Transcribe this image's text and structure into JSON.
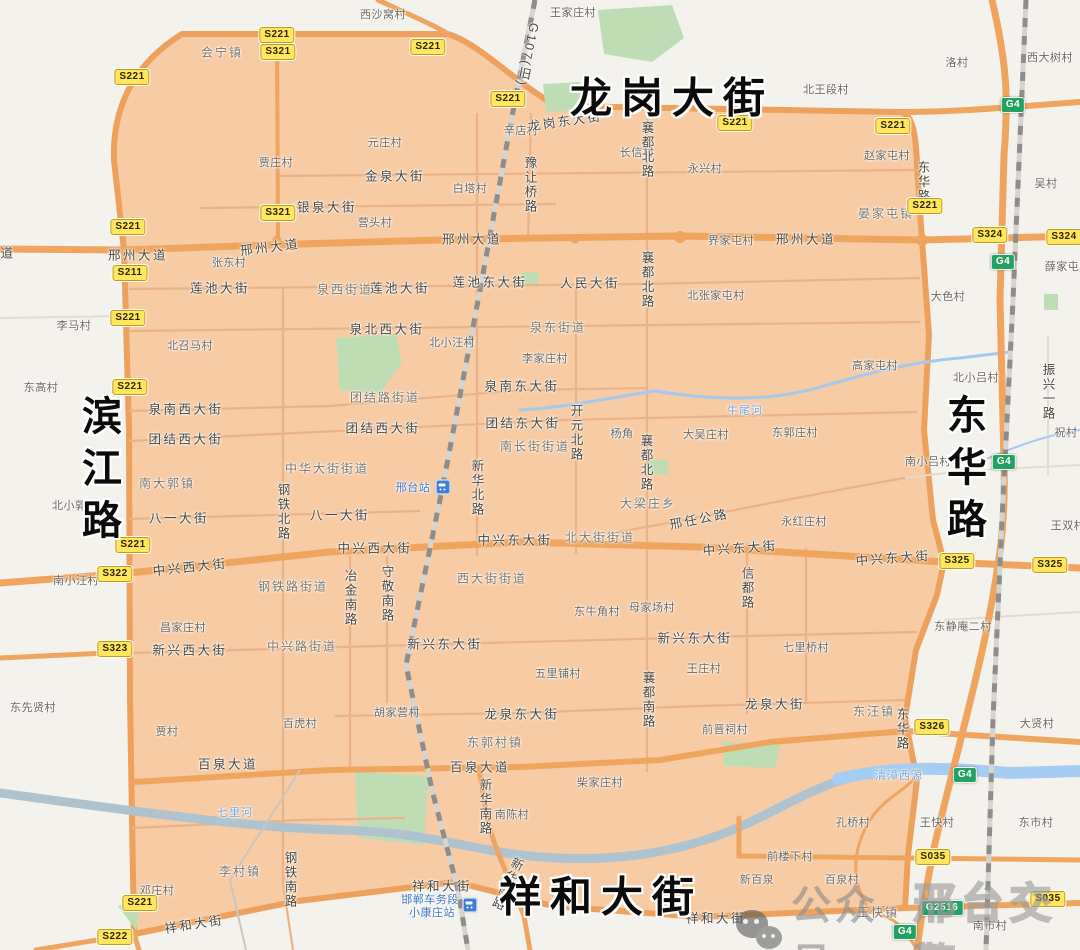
{
  "colors": {
    "zone_fill": "#f7cba4",
    "zone_road": "#eda15c",
    "road_orange": "#efa55e",
    "minor_road": "#eab286",
    "river": "#afc3cf",
    "river_blue": "#a5cdf2",
    "park": "#bfddb4",
    "railway": "#8f8d89",
    "shield_provincial_bg": "#ffe65e",
    "shield_national_bg": "#23a162",
    "big_label": "#0b0b0b"
  },
  "watermark": {
    "icon": "wechat-icon",
    "prefix": "公众号",
    "account": "邢台交警"
  },
  "map": {
    "big_labels_note": "boundary streets of the restricted zone",
    "labels": [
      {
        "t": "龙岗大街",
        "x": 672,
        "y": 95,
        "k": "big"
      },
      {
        "t": "滨江路",
        "x": 98,
        "y": 473,
        "k": "big-v"
      },
      {
        "t": "东华路",
        "x": 963,
        "y": 472,
        "k": "big-v"
      },
      {
        "t": "祥和大街",
        "x": 601,
        "y": 894,
        "k": "big"
      },
      {
        "t": "西沙窝村",
        "x": 383,
        "y": 14,
        "k": "village"
      },
      {
        "t": "王家庄村",
        "x": 573,
        "y": 12,
        "k": "village"
      },
      {
        "t": "元庄村",
        "x": 385,
        "y": 142,
        "k": "village"
      },
      {
        "t": "贾庄村",
        "x": 276,
        "y": 162,
        "k": "village"
      },
      {
        "t": "白塔村",
        "x": 470,
        "y": 188,
        "k": "village"
      },
      {
        "t": "辛店村",
        "x": 521,
        "y": 130,
        "k": "village"
      },
      {
        "t": "长信村",
        "x": 637,
        "y": 152,
        "k": "village"
      },
      {
        "t": "永兴村",
        "x": 705,
        "y": 168,
        "k": "village"
      },
      {
        "t": "北王段村",
        "x": 826,
        "y": 89,
        "k": "village"
      },
      {
        "t": "洛村",
        "x": 957,
        "y": 62,
        "k": "village"
      },
      {
        "t": "西大树村",
        "x": 1050,
        "y": 57,
        "k": "village"
      },
      {
        "t": "赵家屯村",
        "x": 887,
        "y": 155,
        "k": "village"
      },
      {
        "t": "吴村",
        "x": 1046,
        "y": 183,
        "k": "village"
      },
      {
        "t": "张东村",
        "x": 229,
        "y": 262,
        "k": "village"
      },
      {
        "t": "界家屯村",
        "x": 731,
        "y": 240,
        "k": "village"
      },
      {
        "t": "北张家屯村",
        "x": 716,
        "y": 295,
        "k": "village"
      },
      {
        "t": "大色村",
        "x": 948,
        "y": 296,
        "k": "village"
      },
      {
        "t": "薛家屯",
        "x": 1062,
        "y": 266,
        "k": "village"
      },
      {
        "t": "李马村",
        "x": 74,
        "y": 325,
        "k": "village"
      },
      {
        "t": "东高村",
        "x": 41,
        "y": 387,
        "k": "village"
      },
      {
        "t": "北召马村",
        "x": 190,
        "y": 345,
        "k": "village"
      },
      {
        "t": "北小汪村",
        "x": 452,
        "y": 342,
        "k": "village"
      },
      {
        "t": "李家庄村",
        "x": 545,
        "y": 358,
        "k": "village"
      },
      {
        "t": "营头村",
        "x": 375,
        "y": 222,
        "k": "village"
      },
      {
        "t": "高家屯村",
        "x": 875,
        "y": 365,
        "k": "village"
      },
      {
        "t": "北小吕村",
        "x": 976,
        "y": 377,
        "k": "village"
      },
      {
        "t": "大吴庄村",
        "x": 706,
        "y": 434,
        "k": "village"
      },
      {
        "t": "东郭庄村",
        "x": 795,
        "y": 432,
        "k": "village"
      },
      {
        "t": "杨角",
        "x": 622,
        "y": 433,
        "k": "village"
      },
      {
        "t": "祝村",
        "x": 1066,
        "y": 432,
        "k": "village"
      },
      {
        "t": "北小郭村",
        "x": 75,
        "y": 505,
        "k": "village"
      },
      {
        "t": "南小吕村",
        "x": 928,
        "y": 461,
        "k": "village"
      },
      {
        "t": "永红庄村",
        "x": 804,
        "y": 521,
        "k": "village"
      },
      {
        "t": "王双村",
        "x": 1068,
        "y": 525,
        "k": "village"
      },
      {
        "t": "南小汪村",
        "x": 76,
        "y": 580,
        "k": "village"
      },
      {
        "t": "东牛角村",
        "x": 597,
        "y": 611,
        "k": "village"
      },
      {
        "t": "母家场村",
        "x": 652,
        "y": 607,
        "k": "village"
      },
      {
        "t": "东静庵二村",
        "x": 963,
        "y": 626,
        "k": "village"
      },
      {
        "t": "七里桥村",
        "x": 806,
        "y": 647,
        "k": "village"
      },
      {
        "t": "王庄村",
        "x": 704,
        "y": 668,
        "k": "village"
      },
      {
        "t": "五里铺村",
        "x": 558,
        "y": 673,
        "k": "village"
      },
      {
        "t": "昌家庄村",
        "x": 183,
        "y": 627,
        "k": "village"
      },
      {
        "t": "百虎村",
        "x": 300,
        "y": 723,
        "k": "village"
      },
      {
        "t": "贾村",
        "x": 167,
        "y": 731,
        "k": "village"
      },
      {
        "t": "东先贤村",
        "x": 33,
        "y": 707,
        "k": "village"
      },
      {
        "t": "胡家营村",
        "x": 397,
        "y": 712,
        "k": "village"
      },
      {
        "t": "柴家庄村",
        "x": 600,
        "y": 782,
        "k": "village"
      },
      {
        "t": "南陈村",
        "x": 512,
        "y": 814,
        "k": "village"
      },
      {
        "t": "前晋祠村",
        "x": 725,
        "y": 729,
        "k": "village"
      },
      {
        "t": "大贤村",
        "x": 1037,
        "y": 723,
        "k": "village"
      },
      {
        "t": "孔桥村",
        "x": 853,
        "y": 822,
        "k": "village"
      },
      {
        "t": "王快村",
        "x": 937,
        "y": 822,
        "k": "village"
      },
      {
        "t": "东市村",
        "x": 1036,
        "y": 822,
        "k": "village"
      },
      {
        "t": "前楼下村",
        "x": 790,
        "y": 856,
        "k": "village"
      },
      {
        "t": "邓庄村",
        "x": 157,
        "y": 890,
        "k": "village"
      },
      {
        "t": "南市村",
        "x": 990,
        "y": 925,
        "k": "village"
      },
      {
        "t": "新百泉",
        "x": 757,
        "y": 879,
        "k": "village"
      },
      {
        "t": "百泉村",
        "x": 842,
        "y": 879,
        "k": "village"
      },
      {
        "t": "会宁镇",
        "x": 222,
        "y": 52,
        "k": "town"
      },
      {
        "t": "晏家屯镇",
        "x": 886,
        "y": 213,
        "k": "town"
      },
      {
        "t": "泉西街道",
        "x": 345,
        "y": 289,
        "k": "town"
      },
      {
        "t": "泉东街道",
        "x": 558,
        "y": 327,
        "k": "town"
      },
      {
        "t": "团结路街道",
        "x": 385,
        "y": 397,
        "k": "town"
      },
      {
        "t": "南长街街道",
        "x": 535,
        "y": 446,
        "k": "town"
      },
      {
        "t": "中华大街街道",
        "x": 327,
        "y": 468,
        "k": "town"
      },
      {
        "t": "南大郭镇",
        "x": 167,
        "y": 483,
        "k": "town"
      },
      {
        "t": "大梁庄乡",
        "x": 648,
        "y": 503,
        "k": "town"
      },
      {
        "t": "北大街街道",
        "x": 600,
        "y": 537,
        "k": "town"
      },
      {
        "t": "西大街街道",
        "x": 492,
        "y": 578,
        "k": "town"
      },
      {
        "t": "钢铁路街道",
        "x": 293,
        "y": 586,
        "k": "town"
      },
      {
        "t": "中兴路街道",
        "x": 302,
        "y": 646,
        "k": "town"
      },
      {
        "t": "东郭村镇",
        "x": 495,
        "y": 742,
        "k": "town"
      },
      {
        "t": "东汪镇",
        "x": 874,
        "y": 711,
        "k": "town"
      },
      {
        "t": "李村镇",
        "x": 240,
        "y": 871,
        "k": "town"
      },
      {
        "t": "王快镇",
        "x": 878,
        "y": 912,
        "k": "town"
      },
      {
        "t": "龙岗东大街",
        "x": 565,
        "y": 120,
        "k": "road",
        "r": -8
      },
      {
        "t": "道",
        "x": 8,
        "y": 252,
        "k": "road"
      },
      {
        "t": "邢州大道",
        "x": 138,
        "y": 254,
        "k": "road"
      },
      {
        "t": "邢州大道",
        "x": 270,
        "y": 246,
        "k": "road",
        "r": -7
      },
      {
        "t": "邢州大道",
        "x": 472,
        "y": 238,
        "k": "road"
      },
      {
        "t": "邢州大道",
        "x": 806,
        "y": 238,
        "k": "road"
      },
      {
        "t": "金泉大街",
        "x": 395,
        "y": 175,
        "k": "road"
      },
      {
        "t": "银泉大街",
        "x": 327,
        "y": 206,
        "k": "road"
      },
      {
        "t": "莲池大街",
        "x": 220,
        "y": 287,
        "k": "road"
      },
      {
        "t": "莲池大街",
        "x": 400,
        "y": 287,
        "k": "road"
      },
      {
        "t": "莲池东大街",
        "x": 490,
        "y": 281,
        "k": "road"
      },
      {
        "t": "人民大街",
        "x": 590,
        "y": 282,
        "k": "road"
      },
      {
        "t": "泉北西大街",
        "x": 387,
        "y": 328,
        "k": "road"
      },
      {
        "t": "泉南西大街",
        "x": 186,
        "y": 408,
        "k": "road"
      },
      {
        "t": "泉南东大街",
        "x": 522,
        "y": 385,
        "k": "road"
      },
      {
        "t": "团结西大街",
        "x": 186,
        "y": 438,
        "k": "road"
      },
      {
        "t": "团结西大街",
        "x": 383,
        "y": 427,
        "k": "road"
      },
      {
        "t": "团结东大街",
        "x": 523,
        "y": 422,
        "k": "road"
      },
      {
        "t": "八一大街",
        "x": 179,
        "y": 517,
        "k": "road"
      },
      {
        "t": "八一大街",
        "x": 340,
        "y": 514,
        "k": "road"
      },
      {
        "t": "中兴西大街",
        "x": 190,
        "y": 566,
        "k": "road",
        "r": -6
      },
      {
        "t": "中兴西大街",
        "x": 375,
        "y": 547,
        "k": "road"
      },
      {
        "t": "中兴东大街",
        "x": 515,
        "y": 539,
        "k": "road"
      },
      {
        "t": "中兴东大街",
        "x": 740,
        "y": 547,
        "k": "road",
        "r": -4
      },
      {
        "t": "中兴东大街",
        "x": 893,
        "y": 557,
        "k": "road",
        "r": -4
      },
      {
        "t": "邢任公路",
        "x": 699,
        "y": 518,
        "k": "road",
        "r": -11
      },
      {
        "t": "新兴西大街",
        "x": 190,
        "y": 649,
        "k": "road"
      },
      {
        "t": "新兴东大街",
        "x": 445,
        "y": 643,
        "k": "road"
      },
      {
        "t": "新兴东大街",
        "x": 695,
        "y": 637,
        "k": "road"
      },
      {
        "t": "龙泉大街",
        "x": 775,
        "y": 703,
        "k": "road"
      },
      {
        "t": "龙泉东大街",
        "x": 522,
        "y": 713,
        "k": "road"
      },
      {
        "t": "百泉大道",
        "x": 228,
        "y": 763,
        "k": "road"
      },
      {
        "t": "百泉大道",
        "x": 480,
        "y": 766,
        "k": "road"
      },
      {
        "t": "祥和大街",
        "x": 194,
        "y": 923,
        "k": "road",
        "r": -9
      },
      {
        "t": "祥和大街",
        "x": 442,
        "y": 885,
        "k": "road"
      },
      {
        "t": "祥和大街",
        "x": 716,
        "y": 917,
        "k": "road"
      },
      {
        "t": "G107(旧)",
        "x": 528,
        "y": 55,
        "k": "road-v",
        "r": 12
      },
      {
        "t": "豫让桥路",
        "x": 530,
        "y": 185,
        "k": "road-v"
      },
      {
        "t": "襄都北路",
        "x": 647,
        "y": 150,
        "k": "road-v"
      },
      {
        "t": "襄都北路",
        "x": 647,
        "y": 280,
        "k": "road-v"
      },
      {
        "t": "襄都北路",
        "x": 646,
        "y": 463,
        "k": "road-v"
      },
      {
        "t": "开元北路",
        "x": 576,
        "y": 433,
        "k": "road-v"
      },
      {
        "t": "钢铁北路",
        "x": 283,
        "y": 512,
        "k": "road-v"
      },
      {
        "t": "新华北路",
        "x": 477,
        "y": 488,
        "k": "road-v"
      },
      {
        "t": "守敬南路",
        "x": 387,
        "y": 594,
        "k": "road-v"
      },
      {
        "t": "冶金南路",
        "x": 350,
        "y": 598,
        "k": "road-v"
      },
      {
        "t": "信都路",
        "x": 747,
        "y": 588,
        "k": "road-v"
      },
      {
        "t": "襄都南路",
        "x": 648,
        "y": 700,
        "k": "road-v"
      },
      {
        "t": "新华南路",
        "x": 485,
        "y": 807,
        "k": "road-v"
      },
      {
        "t": "新华南路",
        "x": 507,
        "y": 884,
        "k": "road-v",
        "r": 25
      },
      {
        "t": "钢铁南路",
        "x": 290,
        "y": 880,
        "k": "road-v"
      },
      {
        "t": "东华路",
        "x": 923,
        "y": 182,
        "k": "road-v"
      },
      {
        "t": "东华路",
        "x": 902,
        "y": 729,
        "k": "road-v"
      },
      {
        "t": "振兴一路",
        "x": 1048,
        "y": 392,
        "k": "road-v"
      },
      {
        "t": "牛尾河",
        "x": 745,
        "y": 410,
        "k": "river"
      },
      {
        "t": "七里河",
        "x": 235,
        "y": 812,
        "k": "river"
      },
      {
        "t": "清漳西源",
        "x": 899,
        "y": 775,
        "k": "river"
      },
      {
        "t": "邢台站",
        "x": 413,
        "y": 487,
        "k": "station"
      },
      {
        "t": "邯郸车务段",
        "x": 430,
        "y": 899,
        "k": "station"
      },
      {
        "t": "小康庄站",
        "x": 432,
        "y": 912,
        "k": "station"
      }
    ],
    "station_icons": [
      {
        "x": 443,
        "y": 487
      },
      {
        "x": 470,
        "y": 905
      }
    ],
    "shields": [
      {
        "n": "S221",
        "x": 277,
        "y": 35,
        "c": "s"
      },
      {
        "n": "S321",
        "x": 278,
        "y": 52,
        "c": "s"
      },
      {
        "n": "S221",
        "x": 132,
        "y": 77,
        "c": "s"
      },
      {
        "n": "S221",
        "x": 428,
        "y": 47,
        "c": "s"
      },
      {
        "n": "S221",
        "x": 508,
        "y": 99,
        "c": "s"
      },
      {
        "n": "S221",
        "x": 735,
        "y": 123,
        "c": "s"
      },
      {
        "n": "S221",
        "x": 893,
        "y": 126,
        "c": "s"
      },
      {
        "n": "S321",
        "x": 278,
        "y": 213,
        "c": "s"
      },
      {
        "n": "S221",
        "x": 128,
        "y": 227,
        "c": "s"
      },
      {
        "n": "S211",
        "x": 130,
        "y": 273,
        "c": "s"
      },
      {
        "n": "S221",
        "x": 128,
        "y": 318,
        "c": "s"
      },
      {
        "n": "S221",
        "x": 130,
        "y": 387,
        "c": "s"
      },
      {
        "n": "S221",
        "x": 925,
        "y": 206,
        "c": "s"
      },
      {
        "n": "S324",
        "x": 990,
        "y": 235,
        "c": "s"
      },
      {
        "n": "S324",
        "x": 1064,
        "y": 237,
        "c": "s"
      },
      {
        "n": "S221",
        "x": 133,
        "y": 545,
        "c": "s"
      },
      {
        "n": "S322",
        "x": 115,
        "y": 574,
        "c": "s"
      },
      {
        "n": "S323",
        "x": 115,
        "y": 649,
        "c": "s"
      },
      {
        "n": "S325",
        "x": 957,
        "y": 561,
        "c": "s"
      },
      {
        "n": "S325",
        "x": 1050,
        "y": 565,
        "c": "s"
      },
      {
        "n": "S326",
        "x": 932,
        "y": 727,
        "c": "s"
      },
      {
        "n": "S035",
        "x": 933,
        "y": 857,
        "c": "s"
      },
      {
        "n": "S035",
        "x": 1048,
        "y": 899,
        "c": "s"
      },
      {
        "n": "S221",
        "x": 140,
        "y": 903,
        "c": "s"
      },
      {
        "n": "S222",
        "x": 115,
        "y": 937,
        "c": "s"
      },
      {
        "n": "G4",
        "x": 1013,
        "y": 105,
        "c": "g"
      },
      {
        "n": "G4",
        "x": 1003,
        "y": 262,
        "c": "g"
      },
      {
        "n": "G4",
        "x": 1004,
        "y": 462,
        "c": "g"
      },
      {
        "n": "G4",
        "x": 965,
        "y": 775,
        "c": "g"
      },
      {
        "n": "G2516",
        "x": 942,
        "y": 908,
        "c": "g"
      },
      {
        "n": "G4",
        "x": 905,
        "y": 932,
        "c": "g"
      }
    ]
  }
}
